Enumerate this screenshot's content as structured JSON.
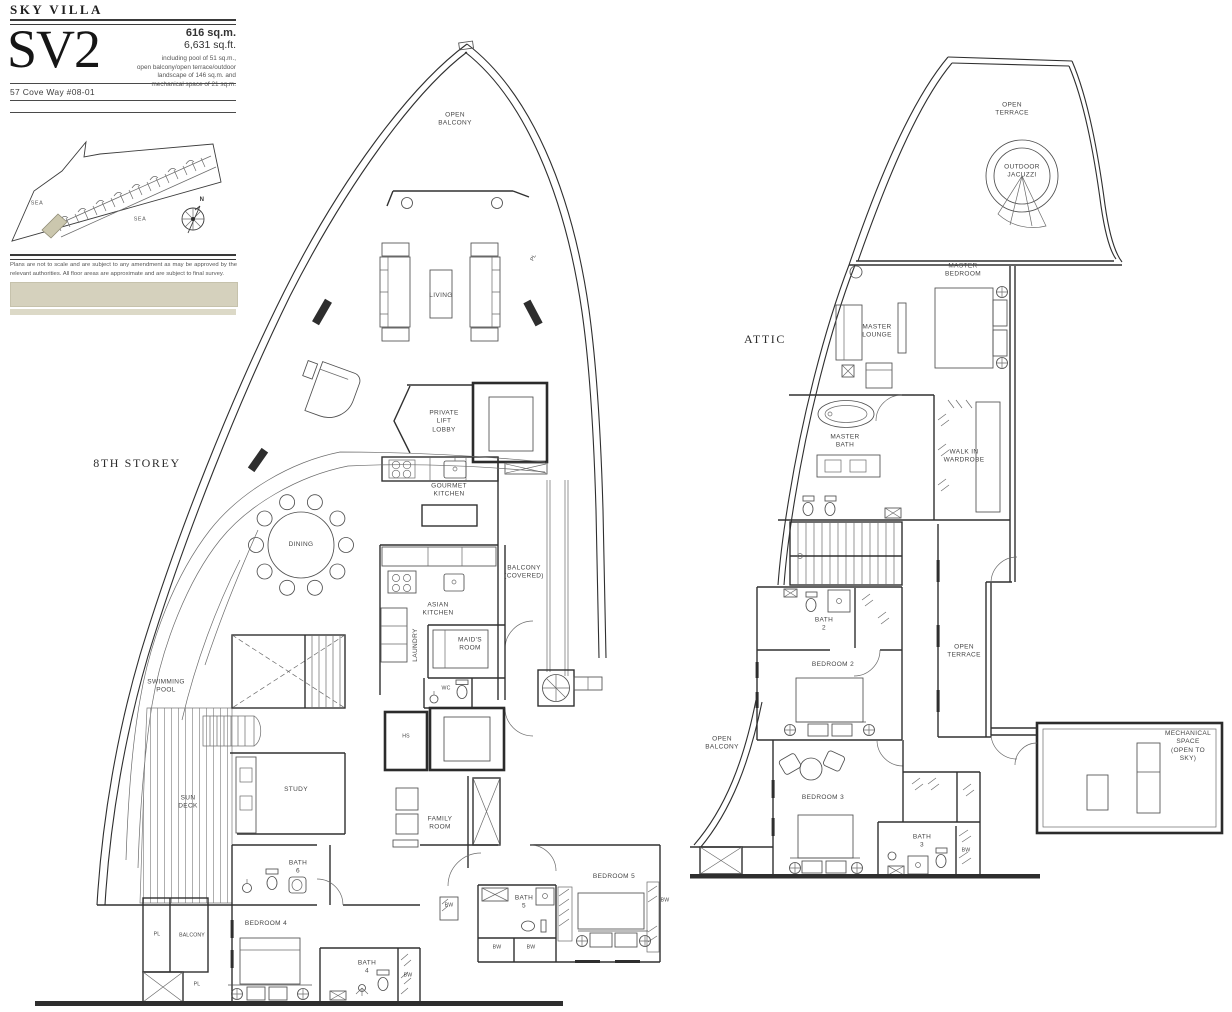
{
  "header": {
    "project": "SKY VILLA",
    "unit": "SV2",
    "area_sqm": "616 sq.m.",
    "area_sqft": "6,631 sq.ft.",
    "area_note": "including pool of 51 sq.m.,\nopen balcony/open terrace/outdoor\nlandscape of 146 sq.m. and\nmechanical space of 21 sq.m.",
    "address": "57 Cove Way #08-01"
  },
  "site_plan": {
    "sea_left": "SEA",
    "sea_right": "SEA",
    "compass_north": "N"
  },
  "disclaimer": "Plans are not to scale and are subject to any amendment as may be approved by the relevant authorities. All floor areas are approximate and are subject to final survey.",
  "floor_8": {
    "title": "8TH STOREY",
    "rooms": {
      "open_balcony": "OPEN\nBALCONY",
      "pl_upper": "PL",
      "living": "LIVING",
      "private_lift_lobby": "PRIVATE\nLIFT\nLOBBY",
      "gourmet_kitchen": "GOURMET\nKITCHEN",
      "dining": "DINING",
      "balcony_covered": "BALCONY\n(COVERED)",
      "asian_kitchen": "ASIAN\nKITCHEN",
      "laundry": "LAUNDRY",
      "maids_room": "MAID'S\nROOM",
      "wc": "WC",
      "hs": "HS",
      "swimming_pool": "SWIMMING\nPOOL",
      "sun_deck": "SUN\nDECK",
      "study": "STUDY",
      "family_room": "FAMILY\nROOM",
      "bath_6": "BATH\n6",
      "bedroom_4": "BEDROOM 4",
      "pl_left": "PL",
      "balcony_left": "BALCONY",
      "pl_lower": "PL",
      "bath_4": "BATH\n4",
      "bath_5": "BATH\n5",
      "bedroom_5": "BEDROOM 5",
      "bw_a": "BW",
      "bw_b": "BW",
      "bw_c": "BW",
      "bw_d": "BW",
      "bw_e": "BW"
    }
  },
  "attic": {
    "title": "ATTIC",
    "rooms": {
      "open_terrace": "OPEN\nTERRACE",
      "outdoor_jacuzzi": "OUTDOOR\nJACUZZI",
      "master_bedroom": "MASTER\nBEDROOM",
      "master_lounge": "MASTER\nLOUNGE",
      "master_bath": "MASTER\nBATH",
      "walk_in_wardrobe": "WALK IN\nWARDROBE",
      "bath_2": "BATH\n2",
      "bedroom_2": "BEDROOM 2",
      "open_terrace_side": "OPEN\nTERRACE",
      "open_balcony": "OPEN\nBALCONY",
      "bedroom_3": "BEDROOM 3",
      "bath_3": "BATH\n3",
      "bw_a": "BW",
      "mechanical_space": "MECHANICAL\nSPACE\n(OPEN TO SKY)"
    }
  }
}
